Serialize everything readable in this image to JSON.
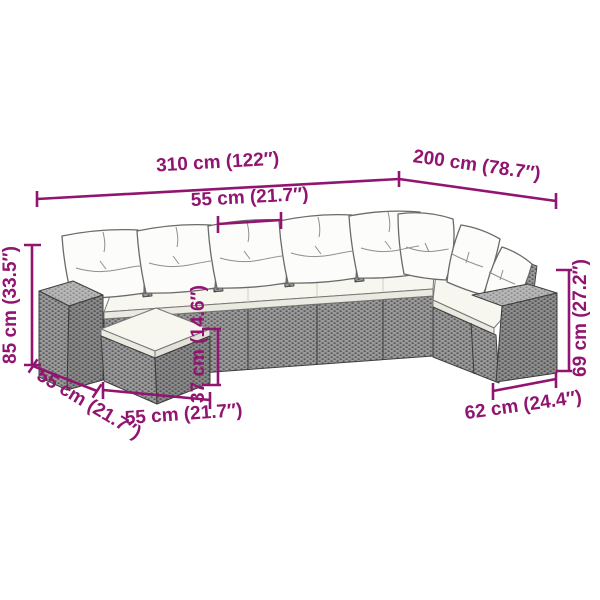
{
  "diagram": {
    "kind": "product-dimension-diagram",
    "subject": "L-shaped poly rattan garden sofa set with cushions and footstool",
    "accent_color": "#911570",
    "rattan_color": "#9a9a9a",
    "cushion_color": "#f7f7ef"
  },
  "measurements": {
    "total_width": {
      "cm": 310,
      "in": 122,
      "label": "310 cm (122″)"
    },
    "right_depth": {
      "cm": 200,
      "in": 78.7,
      "label": "200 cm (78.7″)"
    },
    "seat_width": {
      "cm": 55,
      "in": 21.7,
      "label": "55 cm (21.7″)"
    },
    "total_height": {
      "cm": 85,
      "in": 33.5,
      "label": "85 cm (33.5″)"
    },
    "side_depth": {
      "cm": 55,
      "in": 21.7,
      "label": "55 cm (21.7″)"
    },
    "seat_height": {
      "cm": 37,
      "in": 14.6,
      "label": "37 cm (14.6″)"
    },
    "footstool_width": {
      "cm": 55,
      "in": 21.7,
      "label": "55 cm (21.7″)"
    },
    "armrest_height": {
      "cm": 69,
      "in": 27.2,
      "label": "69 cm (27.2″)"
    },
    "armrest_depth": {
      "cm": 62,
      "in": 24.4,
      "label": "62 cm (24.4″)"
    }
  }
}
